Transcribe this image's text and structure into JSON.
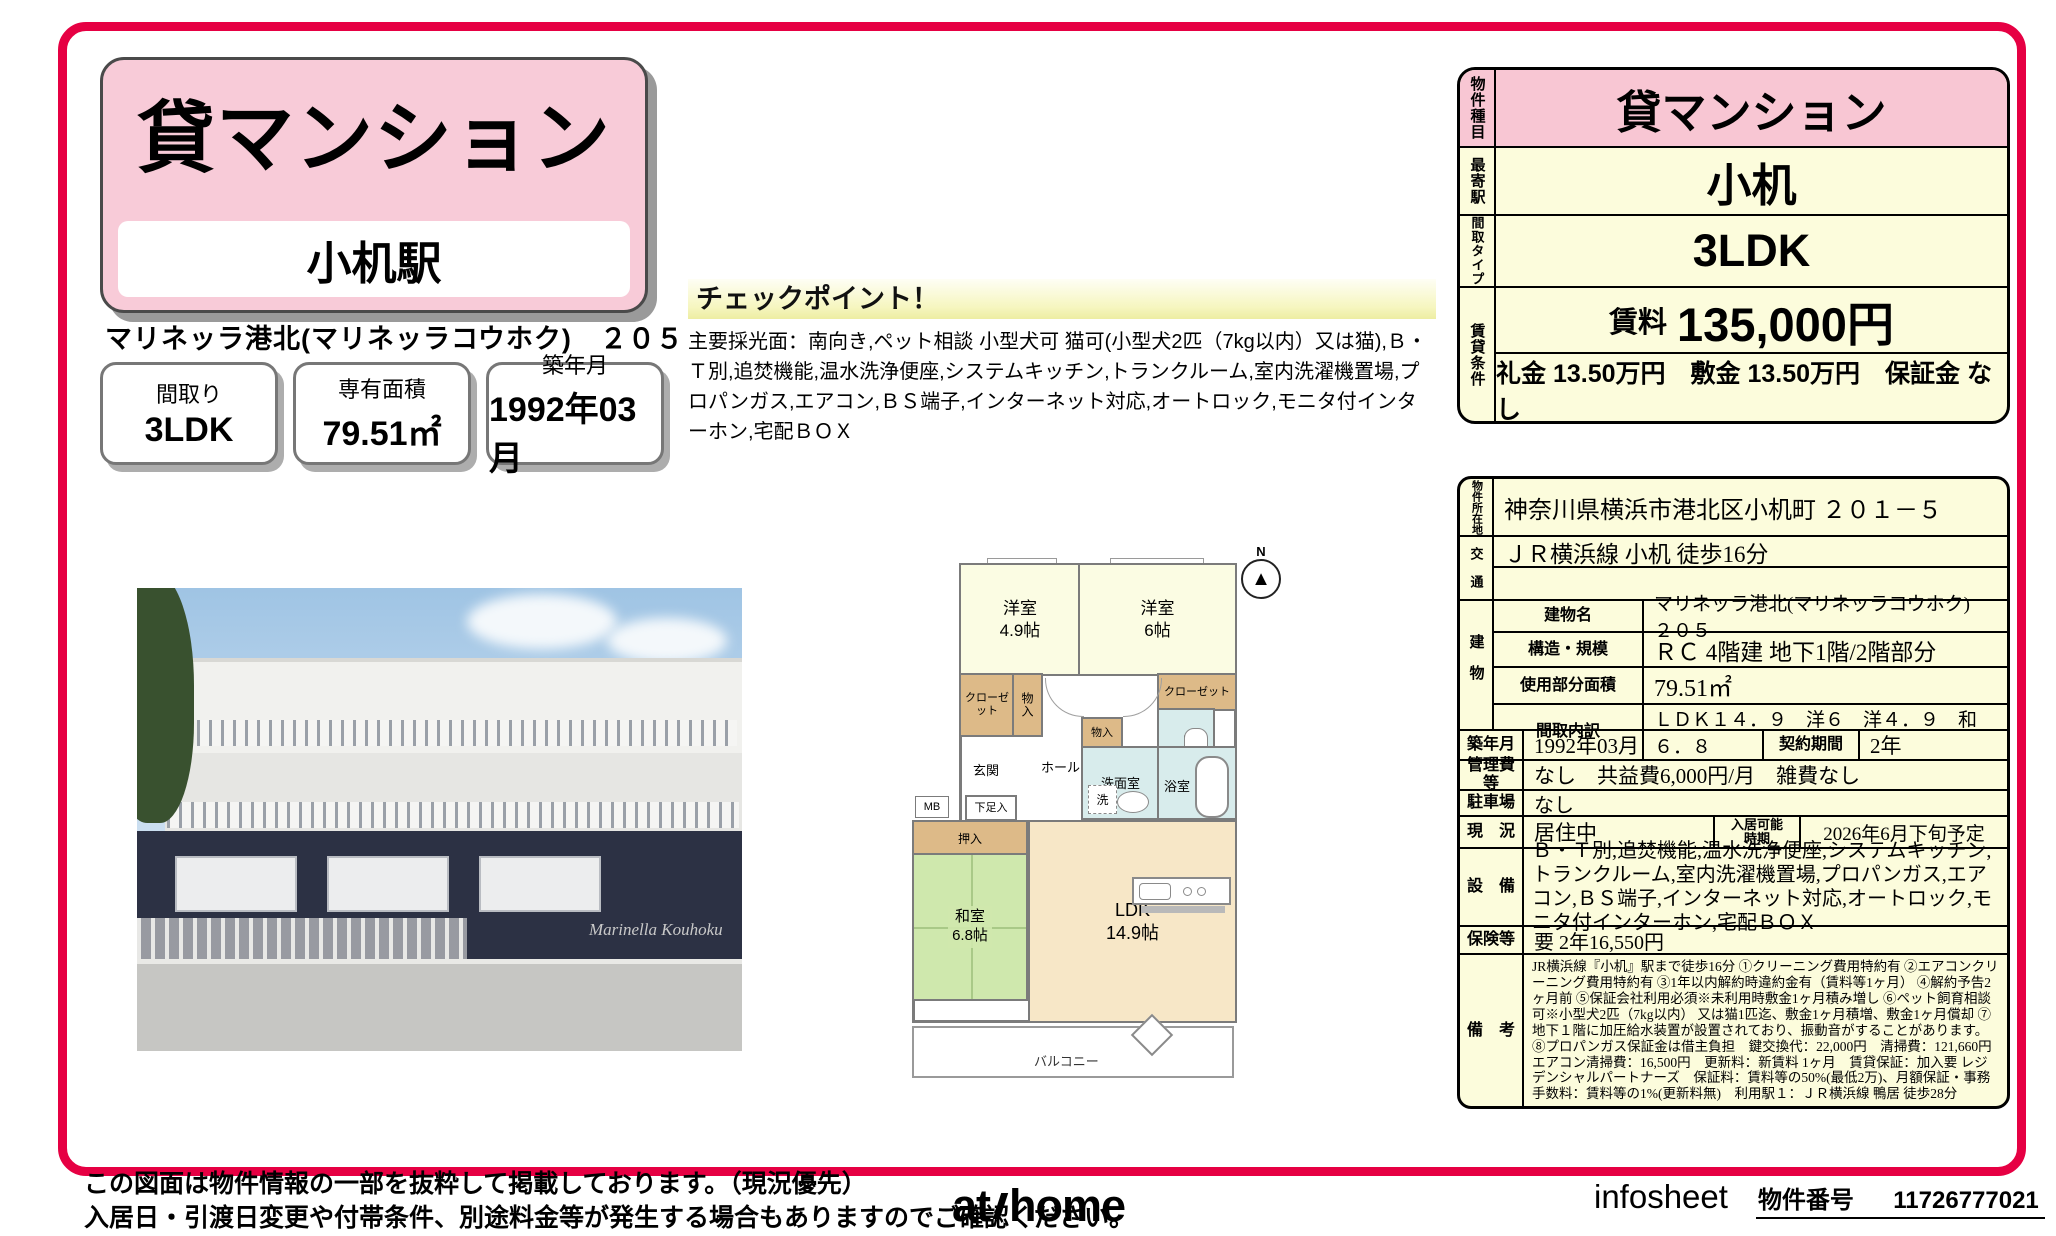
{
  "title_card": {
    "category": "貸マンション",
    "station": "小机駅"
  },
  "property_line": "マリネッラ港北(マリネッラコウホク)　２０５",
  "stat_boxes": [
    {
      "label": "間取り",
      "value": "3LDK"
    },
    {
      "label": "専有面積",
      "value": "79.51㎡"
    },
    {
      "label": "築年月",
      "value": "1992年03月"
    }
  ],
  "checkpoint": {
    "heading": "チェックポイント！",
    "body": "主要採光面：南向き,ペット相談 小型犬可 猫可(小型犬2匹（7kg以内）又は猫),Ｂ・Ｔ別,追焚機能,温水洗浄便座,システムキッチン,トランクルーム,室内洗濯機置場,プロパンガス,エアコン,ＢＳ端子,インターネット対応,オートロック,モニタ付インターホン,宅配ＢＯＸ"
  },
  "photo": {
    "caption": "Marinella Kouhoku"
  },
  "floorplan": {
    "compass": "N",
    "compass_arrow": "▲",
    "rooms": {
      "western1_name": "洋室",
      "western1_size": "4.9帖",
      "western2_name": "洋室",
      "western2_size": "6帖",
      "closet_left": "クローゼット",
      "storage1": "物入",
      "closet_right": "クローゼット",
      "toilet": "トイレ",
      "storage2": "物入",
      "entrance": "玄関",
      "hall": "ホール",
      "washroom": "洗面室",
      "washer": "洗",
      "bathroom": "浴室",
      "shoe_box": "下足入",
      "mb": "MB",
      "oshiire": "押入",
      "japanese_name": "和室",
      "japanese_size": "6.8帖",
      "ldk_name": "LDK",
      "ldk_size": "14.9帖",
      "balcony": "バルコニー"
    }
  },
  "summary_table": {
    "type_label": "物件種目",
    "type_value": "貸マンション",
    "station_label": "最寄駅",
    "station_value": "小机",
    "layout_label": "間取タイプ",
    "layout_value": "3LDK",
    "terms_label": "賃貸条件",
    "rent_label": "賃料",
    "rent_value": "135,000円",
    "terms_value": "礼金 13.50万円　敷金 13.50万円　保証金 なし"
  },
  "detail_table": {
    "address_label": "物件所在地",
    "address": "神奈川県横浜市港北区小机町 ２０１－５",
    "access_label": "交　通",
    "access1": "ＪＲ横浜線 小机 徒歩16分",
    "access2": "",
    "building_label": "建物",
    "building_rows": [
      {
        "label": "建物名",
        "value": "マリネッラ港北(マリネッラコウホク)　２０５"
      },
      {
        "label": "構造・規模",
        "value": "ＲＣ 4階建 地下1階/2階部分"
      },
      {
        "label": "使用部分面積",
        "value": "79.51㎡"
      },
      {
        "label": "間取内訳",
        "value": "ＬＤＫ１４．９　洋６　洋４．９　和６．８"
      }
    ],
    "built_label": "築年月",
    "built": "1992年03月",
    "contract_label": "契約期間",
    "contract": "2年",
    "fees_label": "管理費等",
    "fees": "なし　共益費6,000円/月　雑費なし",
    "parking_label": "駐車場",
    "parking": "なし",
    "status_label": "現　況",
    "status": "居住中",
    "movein_label": "入居可能時期",
    "movein": "2026年6月下旬予定",
    "equipment_label": "設　備",
    "equipment": "Ｂ・Ｔ別,追焚機能,温水洗浄便座,システムキッチン,トランクルーム,室内洗濯機置場,プロパンガス,エアコン,ＢＳ端子,インターネット対応,オートロック,モニタ付インターホン,宅配ＢＯＸ",
    "insurance_label": "保険等",
    "insurance": "要 2年16,550円",
    "remarks_label": "備　考",
    "remarks": "JR横浜線『小机』駅まで徒歩16分 ①クリーニング費用特約有 ②エアコンクリーニング費用特約有 ③1年以内解約時違約金有（賃料等1ヶ月） ④解約予告2ヶ月前 ⑤保証会社利用必須※未利用時敷金1ヶ月積み増し ⑥ペット飼育相談可※小型犬2匹（7kg以内） 又は猫1匹迄、敷金1ヶ月積増、敷金1ヶ月償却 ⑦地下１階に加圧給水装置が設置されており、振動音がすることがあります。 ⑧プロパンガス保証金は借主負担　鍵交換代：22,000円　清掃費：121,660円　エアコン清掃費：16,500円　更新料：新賃料 1ヶ月　賃貸保証：加入要 レジデンシャルパートナーズ　保証料：賃料等の50%(最低2万)、月額保証・事務手数料：賃料等の1%(更新料無)　利用駅１：ＪＲ横浜線 鴨居 徒歩28分"
  },
  "footer": {
    "disclaimer1": "この図面は物件情報の一部を抜粋して掲載しております。（現況優先）",
    "disclaimer2": "入居日・引渡日変更や付帯条件、別途料金等が発生する場合もありますのでご確認ください。",
    "logo_at": "at",
    "logo_home": "home",
    "sheet_name": "infosheet",
    "property_no_label": "物件番号",
    "property_no": "11726777021"
  },
  "colors": {
    "frame": "#e60043",
    "pink": "#f8c6d3",
    "cream": "#fcfcdc"
  }
}
